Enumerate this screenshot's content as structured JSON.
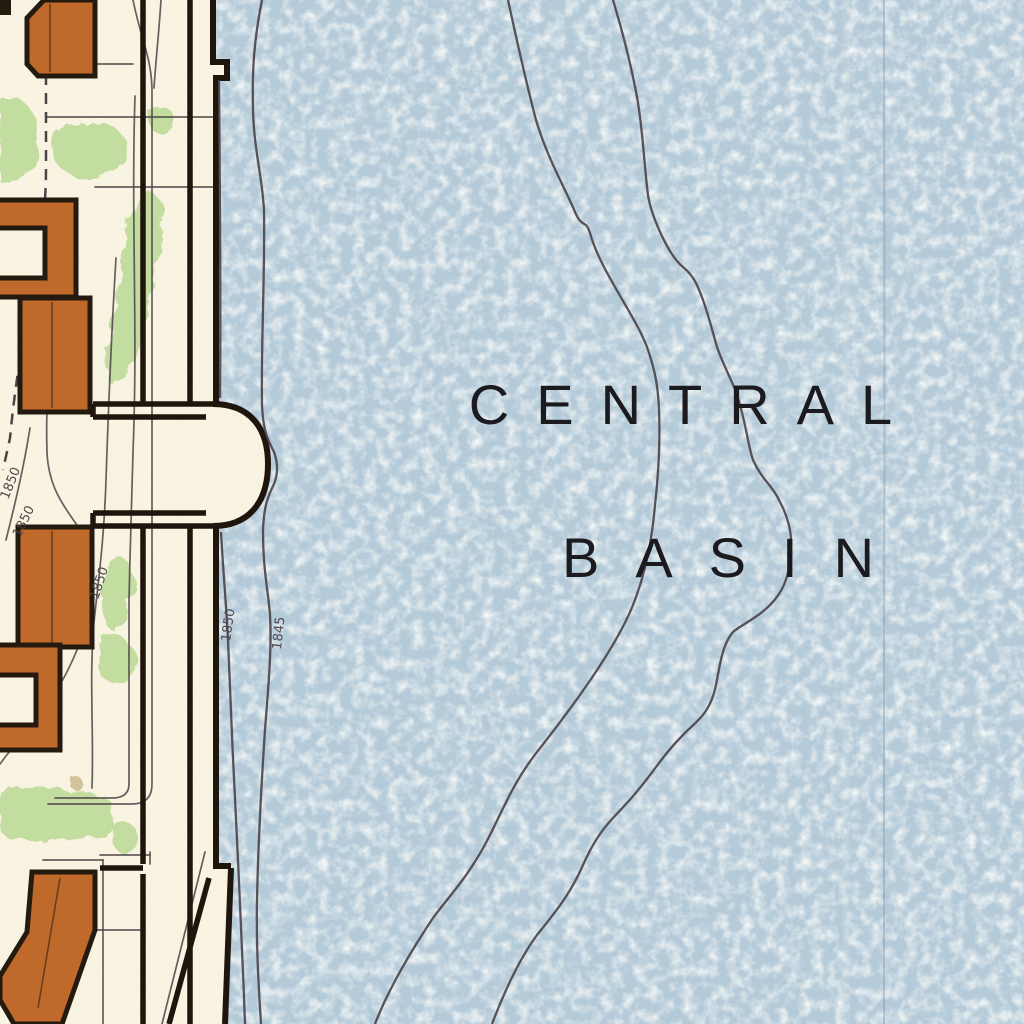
{
  "map": {
    "basin_name": {
      "line1": "CENTRAL",
      "line2": "BASIN"
    },
    "depth_labels": [
      {
        "value": "1850"
      },
      {
        "value": "1850"
      },
      {
        "value": "1850"
      },
      {
        "value": "1850"
      },
      {
        "value": "1845"
      }
    ]
  },
  "colors": {
    "water": "#b4cad9",
    "land": "#f9f3e2",
    "building": "#bf6a2b",
    "outline": "#241a10",
    "structure": "#20150c",
    "vegetation": "#b5d68f",
    "thin-line": "#4e4347",
    "boundary": "#3a3136",
    "contour": "#4a4147",
    "label": "#1b1a1f",
    "fold": "#7d94a7",
    "stain": "#9a7a33"
  }
}
